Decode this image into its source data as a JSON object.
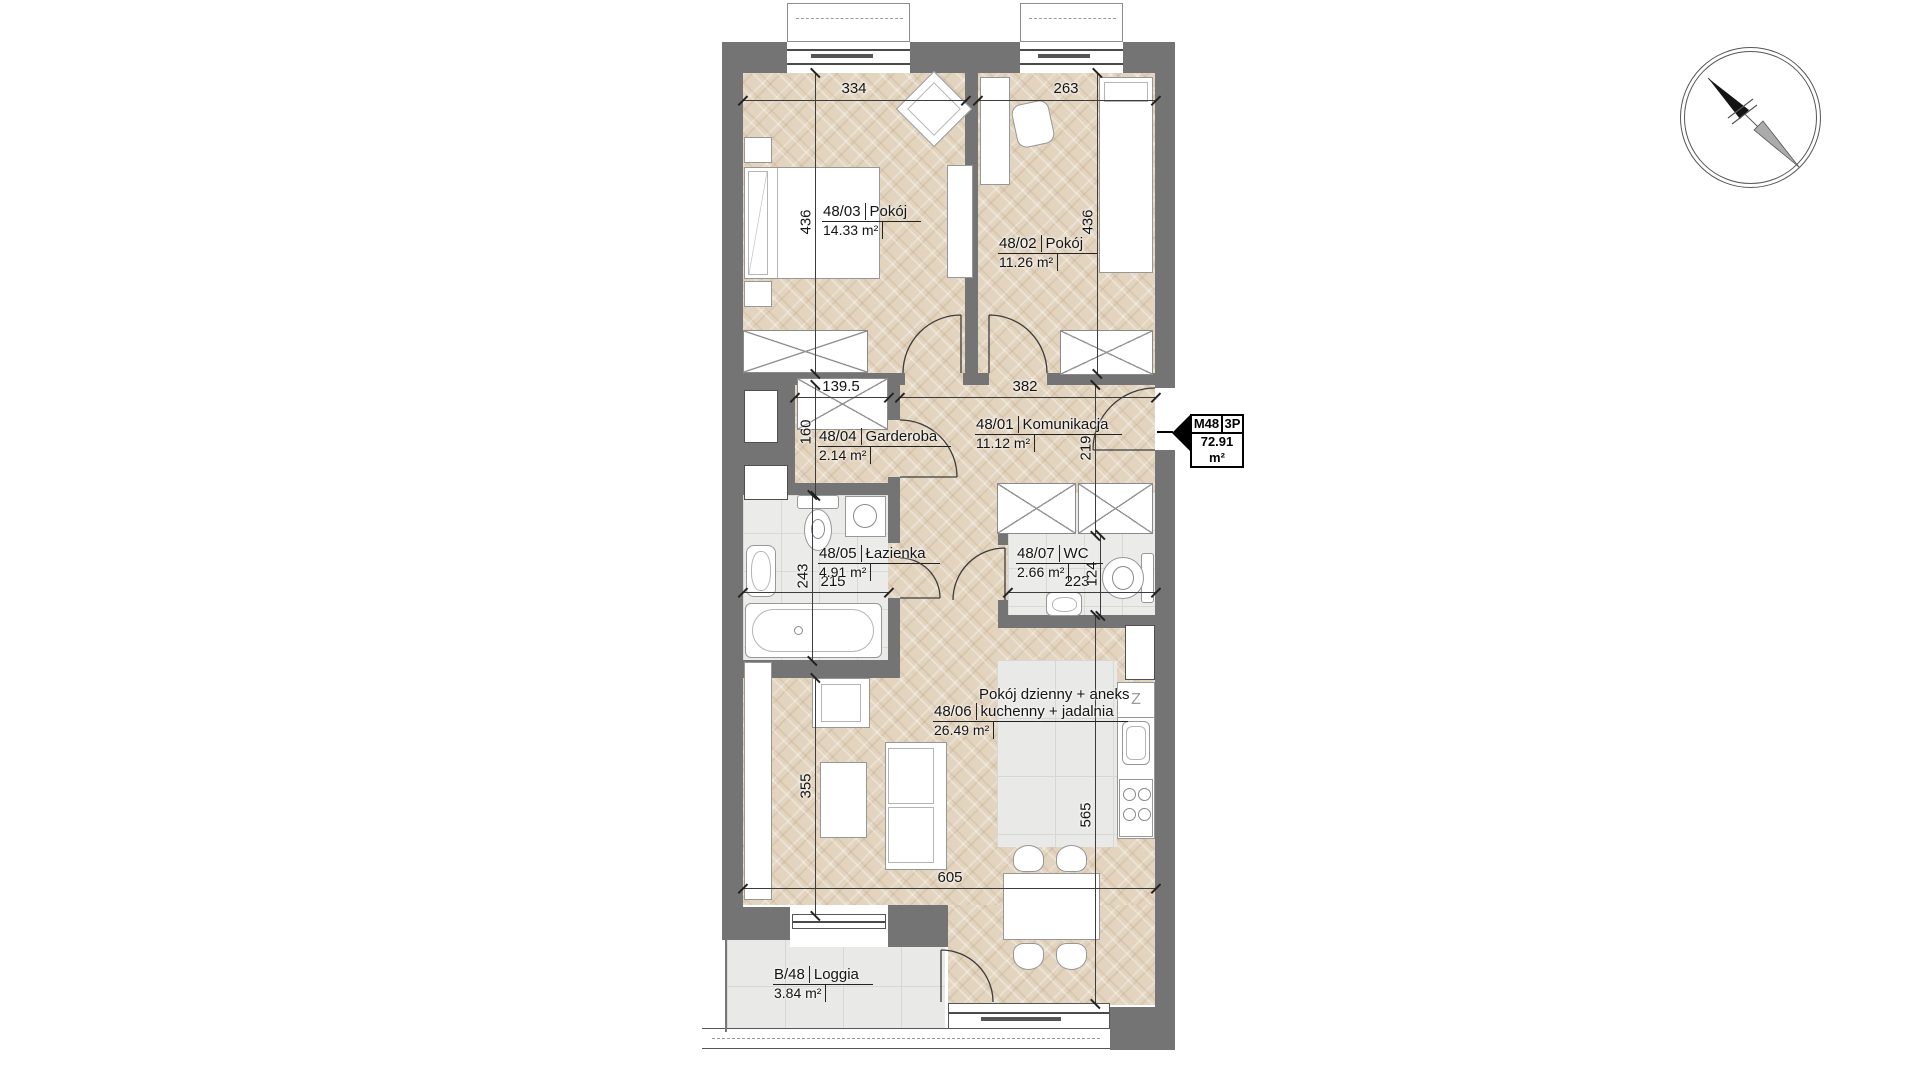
{
  "unit_tag": {
    "code": "M48",
    "layout": "3P",
    "area": "72.91 m²"
  },
  "rooms": {
    "pokoj3": {
      "id": "48/03",
      "name": "Pokój",
      "area": "14.33 m²"
    },
    "pokoj2": {
      "id": "48/02",
      "name": "Pokój",
      "area": "11.26 m²"
    },
    "garderoba": {
      "id": "48/04",
      "name": "Garderoba",
      "area": "2.14 m²"
    },
    "komunikacja": {
      "id": "48/01",
      "name": "Komunikacja",
      "area": "11.12 m²"
    },
    "lazienka": {
      "id": "48/05",
      "name": "Łazienka",
      "area": "4.91 m²"
    },
    "wc": {
      "id": "48/07",
      "name": "WC",
      "area": "2.66 m²"
    },
    "salon": {
      "id": "48/06",
      "line1": "Pokój dzienny + aneks",
      "name": "kuchenny + jadalnia",
      "area": "26.49 m²"
    },
    "loggia": {
      "id": "B/48",
      "name": "Loggia",
      "area": "3.84 m²"
    }
  },
  "dimensions": {
    "pokoj3_w": "334",
    "pokoj2_w": "263",
    "pokoj3_h": "436",
    "pokoj2_h": "436",
    "garderoba_w": "139.5",
    "korytarz_w": "382",
    "garderoba_h": "160",
    "korytarz_h": "219",
    "lazienka_h": "243",
    "lazienka_w": "215",
    "wc_w": "223",
    "wc_h": "124",
    "salon_h_left": "355",
    "salon_h_right": "565",
    "salon_w": "605"
  },
  "kitchen": {
    "dishwasher_label": "Z"
  },
  "colors": {
    "wall": "#747474",
    "wood": "#e2d4bf",
    "tile": "#ebecea",
    "accent": "#000000"
  }
}
